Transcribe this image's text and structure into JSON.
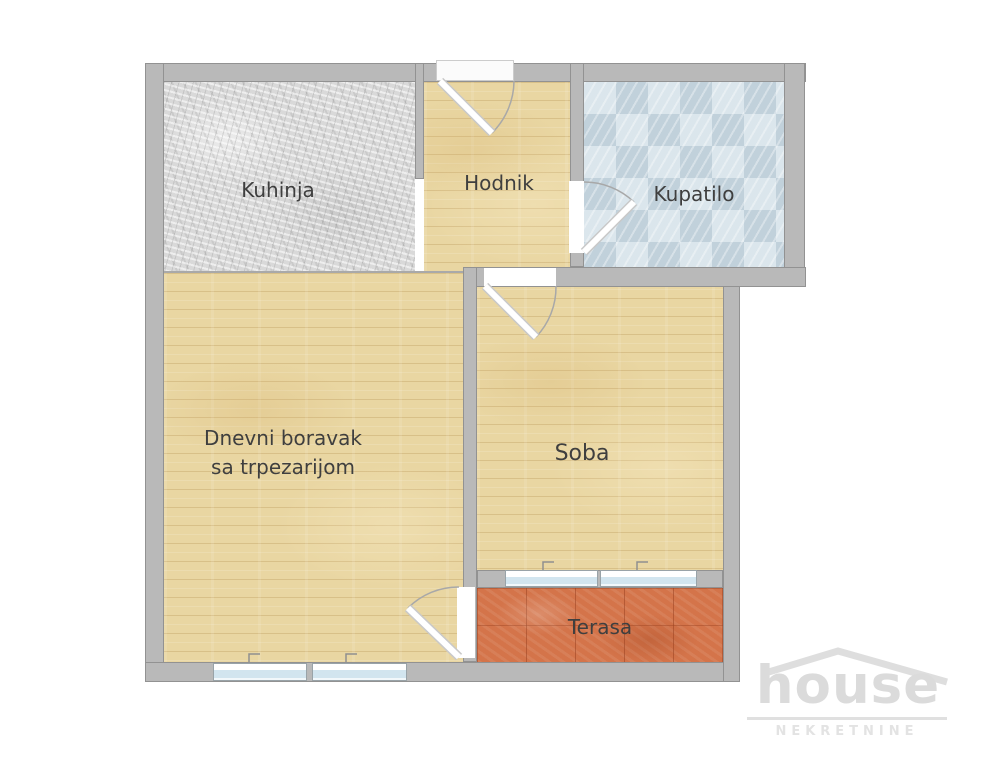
{
  "floorplan": {
    "rooms": {
      "kuhinja": "Kuhinja",
      "hodnik": "Hodnik",
      "kupatilo": "Kupatilo",
      "dnevni_line1": "Dnevni boravak",
      "dnevni_line2": "sa trpezarijom",
      "soba": "Soba",
      "terasa": "Terasa"
    },
    "colors": {
      "wall": "#b9b9b9",
      "wall_outline": "#929292",
      "wood_floor": "#e9d6a2",
      "kitchen_marble": "#d9d9d9",
      "bathroom_tile": "#d4e1e8",
      "terrace_tile": "#d4744a",
      "window_glass": "#d2e5ef",
      "door_leaf": "#ffffff",
      "label_text": "#3f3f3f",
      "logo_gray": "#dcdcdc"
    }
  },
  "logo": {
    "brand": "house",
    "tagline": "NEKRETNINE"
  }
}
